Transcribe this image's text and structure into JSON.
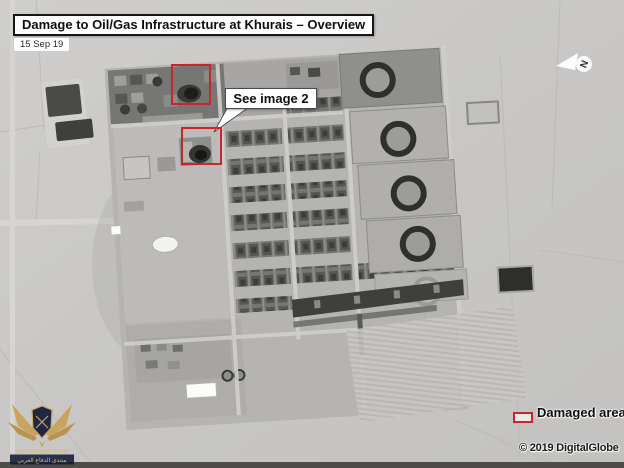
{
  "header": {
    "title": "Damage to Oil/Gas Infrastructure at Khurais – Overview",
    "date": "15 Sep 19"
  },
  "callout": {
    "label": "See image 2"
  },
  "legend": {
    "label": "Damaged area"
  },
  "credit": {
    "copyright": "© 2019 DigitalGlobe"
  },
  "compass": {
    "label": "N"
  },
  "watermark": {
    "org": "ARAB DEFENSE FORUM",
    "org_arabic": "منتدى الدفاع العربي"
  },
  "colors": {
    "damage_annotation": "#c8262b",
    "annotation_background": "#ffffff",
    "annotation_text": "#101010",
    "logo_gold": "#c9a35a",
    "logo_navy": "#141c3a"
  }
}
